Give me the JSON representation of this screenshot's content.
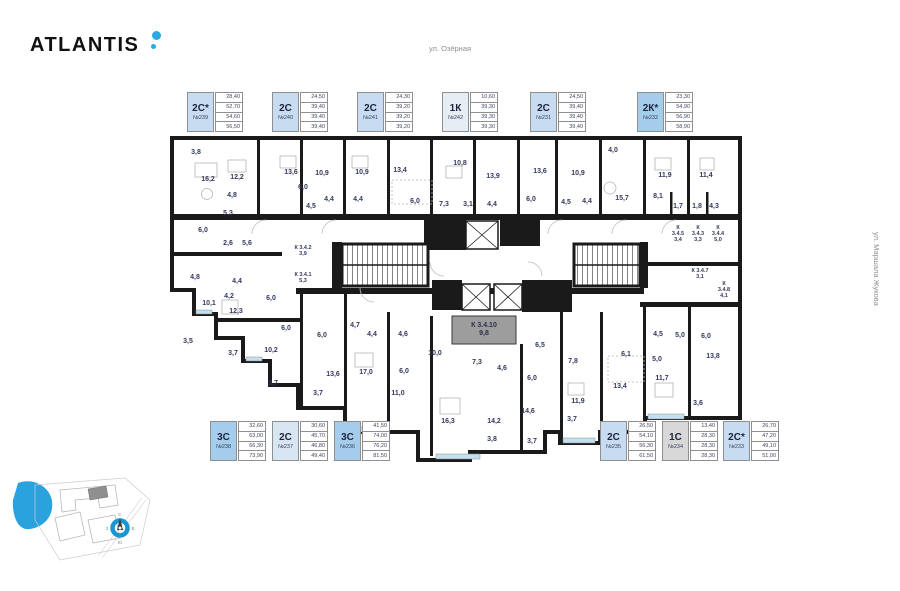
{
  "logo": {
    "text": "ATLANTIS",
    "dot_color": "#29abe2"
  },
  "streets": {
    "top": "ул. Озёрная",
    "right": "ул. Маршала Жукова"
  },
  "cards_top": [
    {
      "type": "2С*",
      "number": "№239",
      "areas": [
        "28,40",
        "52,70",
        "54,60",
        "56,50"
      ],
      "color": "#c7dcf0"
    },
    {
      "type": "2С",
      "number": "№240",
      "areas": [
        "24,50",
        "39,40",
        "39,40",
        "39,40"
      ],
      "color": "#c7dcf0"
    },
    {
      "type": "2С",
      "number": "№241",
      "areas": [
        "24,30",
        "39,20",
        "39,20",
        "39,20"
      ],
      "color": "#c7dcf0"
    },
    {
      "type": "1К",
      "number": "№242",
      "areas": [
        "10,60",
        "39,30",
        "39,30",
        "39,30"
      ],
      "color": "#e7edf5"
    },
    {
      "type": "2С",
      "number": "№231",
      "areas": [
        "24,50",
        "39,40",
        "39,40",
        "39,40"
      ],
      "color": "#c7dcf0"
    },
    {
      "type": "2К*",
      "number": "№232",
      "areas": [
        "23,30",
        "54,90",
        "56,90",
        "58,90"
      ],
      "color": "#a4cdeb"
    }
  ],
  "cards_bottom": [
    {
      "type": "3С",
      "number": "№238",
      "areas": [
        "32,60",
        "63,00",
        "66,30",
        "73,90"
      ],
      "color": "#a4cdeb"
    },
    {
      "type": "2С",
      "number": "№237",
      "areas": [
        "30,60",
        "45,70",
        "46,80",
        "49,40"
      ],
      "color": "#d8e5f3"
    },
    {
      "type": "3С",
      "number": "№236",
      "areas": [
        "41,50",
        "74,00",
        "76,20",
        "81,50"
      ],
      "color": "#a4cdeb"
    },
    {
      "type": "2С",
      "number": "№235",
      "areas": [
        "26,50",
        "54,10",
        "56,30",
        "61,50"
      ],
      "color": "#c7dcf0"
    },
    {
      "type": "1С",
      "number": "№234",
      "areas": [
        "13,40",
        "28,30",
        "28,30",
        "28,30"
      ],
      "color": "#d8d8d8"
    },
    {
      "type": "2С*",
      "number": "№233",
      "areas": [
        "26,70",
        "47,20",
        "49,10",
        "51,00"
      ],
      "color": "#c7dcf0"
    }
  ],
  "plan": {
    "highlight_room": {
      "lines": [
        "К 3.4.10",
        "9,8"
      ]
    },
    "rooms": [
      [
        196,
        154,
        "3,8"
      ],
      [
        208,
        181,
        "16,2"
      ],
      [
        237,
        179,
        "12,2"
      ],
      [
        291,
        174,
        "13,6"
      ],
      [
        232,
        197,
        "4,8"
      ],
      [
        303,
        189,
        "6,0"
      ],
      [
        228,
        215,
        "5,3"
      ],
      [
        322,
        175,
        "10,9"
      ],
      [
        362,
        174,
        "10,9"
      ],
      [
        329,
        201,
        "4,4"
      ],
      [
        358,
        201,
        "4,4"
      ],
      [
        311,
        208,
        "4,5"
      ],
      [
        400,
        172,
        "13,4"
      ],
      [
        415,
        203,
        "6,0"
      ],
      [
        444,
        206,
        "7,3"
      ],
      [
        468,
        206,
        "3,1"
      ],
      [
        492,
        206,
        "4,4"
      ],
      [
        493,
        178,
        "13,9"
      ],
      [
        460,
        165,
        "10,8"
      ],
      [
        540,
        173,
        "13,6"
      ],
      [
        531,
        201,
        "6,0"
      ],
      [
        566,
        204,
        "4,5"
      ],
      [
        578,
        175,
        "10,9"
      ],
      [
        587,
        203,
        "4,4"
      ],
      [
        613,
        152,
        "4,0"
      ],
      [
        622,
        200,
        "15,7"
      ],
      [
        658,
        198,
        "8,1"
      ],
      [
        665,
        177,
        "11,9"
      ],
      [
        706,
        177,
        "11,4"
      ],
      [
        678,
        208,
        "1,7"
      ],
      [
        697,
        208,
        "1,8"
      ],
      [
        714,
        208,
        "4,3"
      ],
      [
        203,
        232,
        "6,0"
      ],
      [
        228,
        245,
        "2,6"
      ],
      [
        247,
        245,
        "5,6"
      ],
      [
        195,
        279,
        "4,8"
      ],
      [
        237,
        283,
        "4,4"
      ],
      [
        229,
        298,
        "4,2"
      ],
      [
        209,
        305,
        "10,1"
      ],
      [
        271,
        300,
        "6,0"
      ],
      [
        236,
        313,
        "12,3"
      ],
      [
        286,
        330,
        "6,0"
      ],
      [
        188,
        343,
        "3,5"
      ],
      [
        233,
        355,
        "3,7"
      ],
      [
        271,
        352,
        "10,2"
      ],
      [
        273,
        385,
        "3,7"
      ],
      [
        322,
        337,
        "6,0"
      ],
      [
        372,
        336,
        "4,4"
      ],
      [
        403,
        336,
        "4,6"
      ],
      [
        355,
        327,
        "4,7"
      ],
      [
        435,
        355,
        "10,0"
      ],
      [
        333,
        376,
        "13,6"
      ],
      [
        366,
        374,
        "17,0"
      ],
      [
        404,
        373,
        "6,0"
      ],
      [
        398,
        395,
        "11,0"
      ],
      [
        318,
        395,
        "3,7"
      ],
      [
        448,
        423,
        "16,3"
      ],
      [
        477,
        364,
        "7,3"
      ],
      [
        502,
        370,
        "4,6"
      ],
      [
        540,
        347,
        "6,5"
      ],
      [
        532,
        380,
        "6,0"
      ],
      [
        573,
        363,
        "7,8"
      ],
      [
        626,
        356,
        "6,1"
      ],
      [
        680,
        337,
        "5,0"
      ],
      [
        658,
        336,
        "4,5"
      ],
      [
        706,
        338,
        "6,0"
      ],
      [
        657,
        361,
        "5,0"
      ],
      [
        713,
        358,
        "13,8"
      ],
      [
        620,
        388,
        "13,4"
      ],
      [
        662,
        380,
        "11,7"
      ],
      [
        578,
        403,
        "11,9"
      ],
      [
        528,
        413,
        "14,6"
      ],
      [
        494,
        423,
        "14,2"
      ],
      [
        572,
        421,
        "3,7"
      ],
      [
        492,
        441,
        "3,8"
      ],
      [
        532,
        443,
        "3,7"
      ],
      [
        698,
        405,
        "3,6"
      ]
    ],
    "storage_rooms": [
      [
        303,
        249,
        [
          "К 3.4.2",
          "3,9"
        ]
      ],
      [
        303,
        276,
        [
          "К 3.4.1",
          "5,3"
        ]
      ],
      [
        678,
        229,
        [
          "К",
          "3.4.5",
          "3,4"
        ]
      ],
      [
        698,
        229,
        [
          "К",
          "3.4.3",
          "3,3"
        ]
      ],
      [
        718,
        229,
        [
          "К",
          "3.4.4",
          "5,0"
        ]
      ],
      [
        700,
        272,
        [
          "К 3.4.7",
          "3,1"
        ]
      ],
      [
        724,
        285,
        [
          "К",
          "3.4.8",
          "4,1"
        ]
      ]
    ]
  },
  "compass": {
    "n": "С",
    "e": "В",
    "s": "Ю",
    "w": "З"
  }
}
